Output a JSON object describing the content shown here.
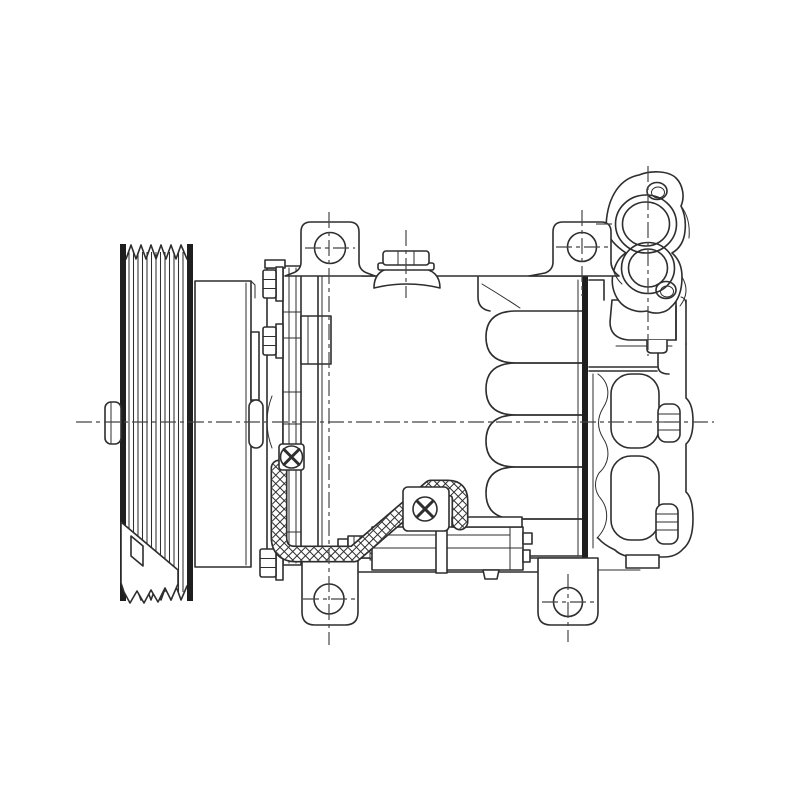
{
  "page": {
    "background": "#ffffff"
  },
  "drawing": {
    "type": "technical-line-drawing",
    "subject": "automotive A/C compressor side view",
    "line_color": "#2e2e2e",
    "centerline_color": "#454545",
    "hatch_color": "#2e2e2e",
    "parts": [
      {
        "id": "pulley",
        "label": "poly-v belt pulley"
      },
      {
        "id": "clutch-drum",
        "label": "clutch drum"
      },
      {
        "id": "front-plate",
        "label": "front clutch plate with bolts"
      },
      {
        "id": "coil-bracket",
        "label": "clutch coil bracket"
      },
      {
        "id": "body",
        "label": "compressor housing with ribbed barrel"
      },
      {
        "id": "gasket",
        "label": "rear gasket plate"
      },
      {
        "id": "rear-head",
        "label": "rear cylinder head casting"
      },
      {
        "id": "port-manifold",
        "label": "suction and discharge port manifold"
      },
      {
        "id": "ear-left",
        "label": "top left mounting ear"
      },
      {
        "id": "ear-right",
        "label": "top right mounting ear"
      },
      {
        "id": "fill-plug",
        "label": "hex oil fill plug"
      },
      {
        "id": "lug-left",
        "label": "bottom left mounting lug"
      },
      {
        "id": "lug-right",
        "label": "bottom right mounting lug"
      },
      {
        "id": "connector",
        "label": "electrical connector block"
      },
      {
        "id": "harness",
        "label": "braided wiring harness"
      },
      {
        "id": "centerlines",
        "label": "datum centerlines"
      }
    ]
  }
}
